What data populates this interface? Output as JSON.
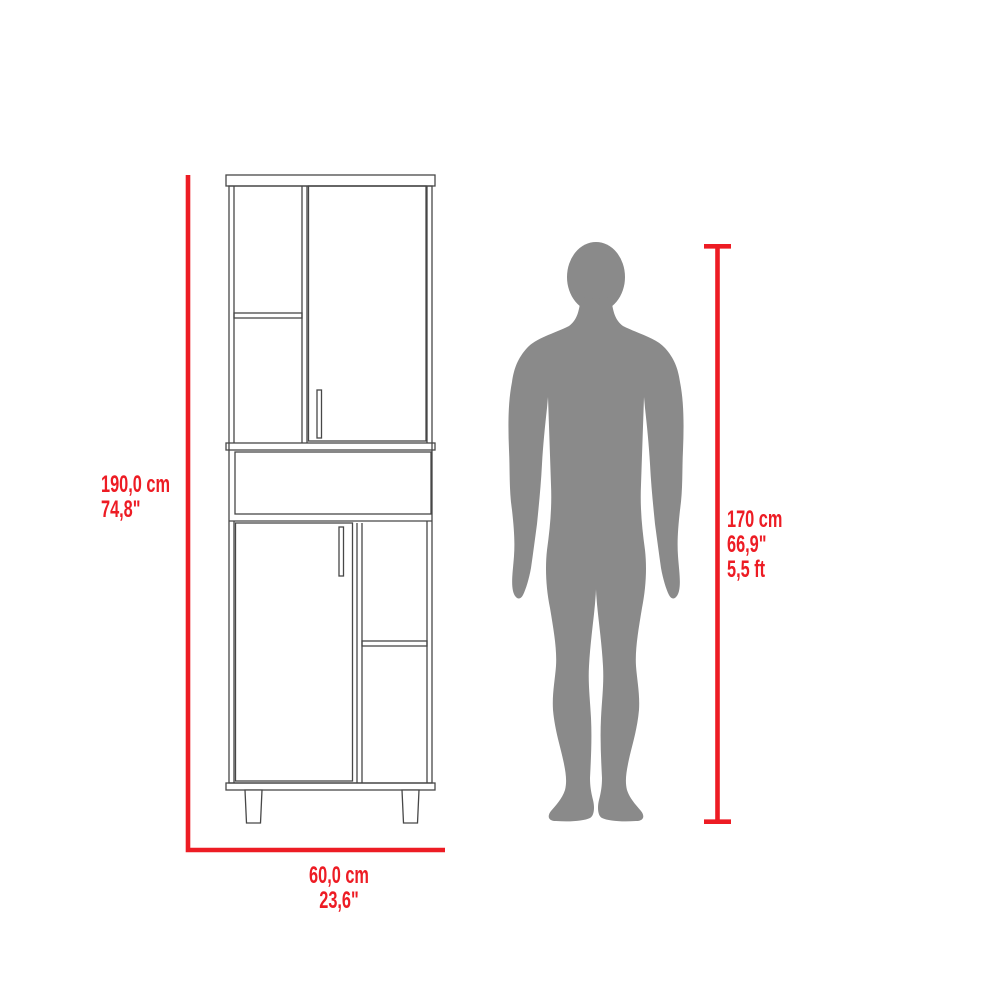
{
  "colors": {
    "dimension_red": "#ed1c24",
    "silhouette_gray": "#8a8a8a",
    "line_dark": "#474747",
    "background": "#ffffff"
  },
  "labels": {
    "cabinet_height": {
      "cm": "190,0 cm",
      "inches": "74,8\""
    },
    "cabinet_width": {
      "cm": "60,0 cm",
      "inches": "23,6\""
    },
    "person_height": {
      "cm": "170 cm",
      "inches": "66,9\"",
      "feet": "5,5 ft"
    }
  }
}
